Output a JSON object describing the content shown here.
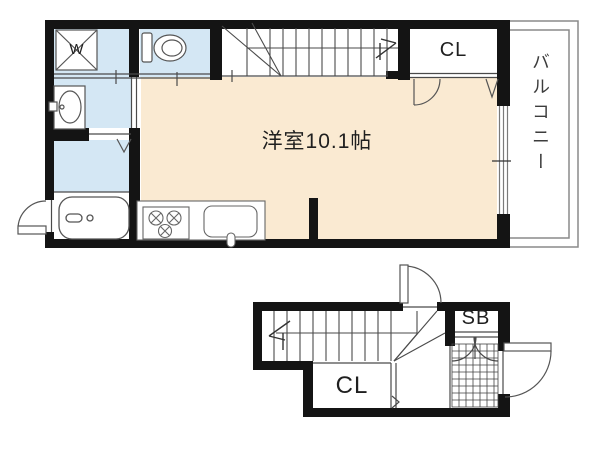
{
  "floorplan": {
    "upper": {
      "room_label": "洋室10.1帖",
      "balcony_label": "バルコニー",
      "closet_label": "CL",
      "washing_machine_label": "W",
      "fixtures": [
        "washing-machine",
        "toilet",
        "washbasin",
        "bathtub",
        "kitchen-stove",
        "kitchen-sink",
        "stairs",
        "closet-door",
        "balcony-window"
      ]
    },
    "lower": {
      "closet_label": "CL",
      "shoe_box_label": "SB",
      "fixtures": [
        "stairs",
        "entrance-door",
        "shoe-box-doors",
        "entrance-tile"
      ]
    },
    "colors": {
      "room_fill": "#faead2",
      "wet_area_fill": "#d4e7f4",
      "wall": "#141414"
    }
  }
}
